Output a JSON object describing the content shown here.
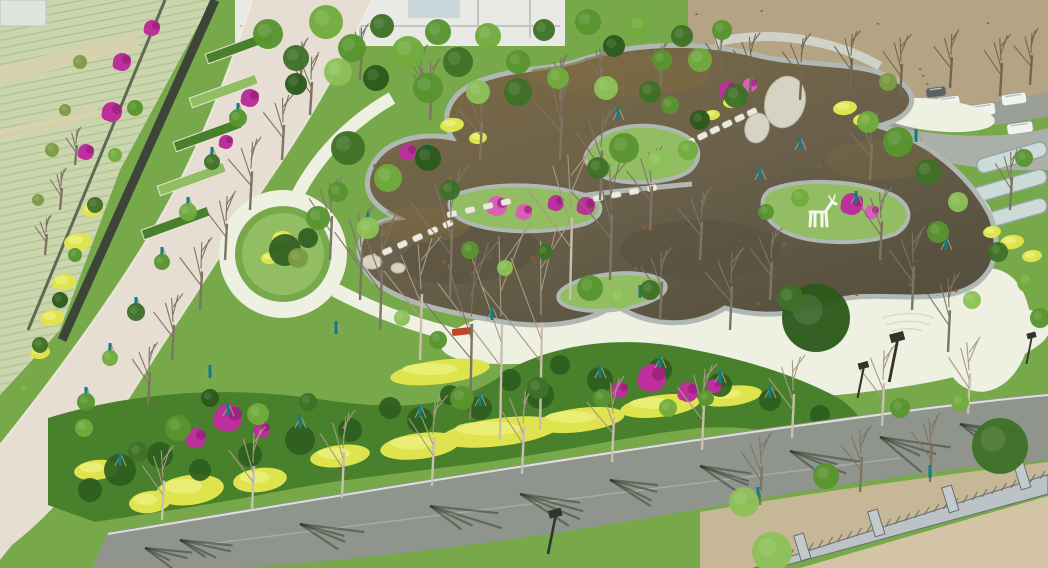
{
  "scene_type": "aerial-drone-photo-of-landscaped-pond-garden-park",
  "palette": {
    "plaza": "#eef0e2",
    "road_light": "#e6ded2",
    "asphalt": "#8f948c",
    "asphalt_light": "#a8aca2",
    "water_top": "#7d6b42",
    "water": "#6a604b",
    "water_dark": "#56503e",
    "speckle": "#8a5c33",
    "stone": "#b0b8b4",
    "stone_dark": "#87928d",
    "slab": "#eceadf",
    "lawn": "#77a94b",
    "lawn_light": "#92bd62",
    "lawn_dark": "#558a34",
    "shrub": "#49802c",
    "shrub_dark": "#2f5d20",
    "hedge_yellow": "#dfe44e",
    "hedge_yellow_light": "#ecf07e",
    "magenta": "#bd2f9b",
    "magenta_dark": "#971c77",
    "pink": "#d95fb8",
    "teal": "#0f7e86",
    "farmland": "#cbd6ae",
    "farmland_row": "#afc392",
    "farmland_tan": "#d8d2ae",
    "wall": "#3d4438",
    "fence_line": "#5f6a55",
    "field": "#b5a484",
    "field_dot": "#70684f",
    "dirt": "#d2c4a4",
    "dirt2": "#c6b896",
    "fence_gray": "#bcc3c6",
    "fence_dark": "#666d70",
    "building": "#e9eae5",
    "building_line": "#c3c6c0",
    "glass": "#c9d6da",
    "greenhouse": "#ccdad8",
    "greenhouse_line": "#8fa5a4",
    "trunk": "#c9c0ae",
    "branch": "#a89a82",
    "branch_dark": "#7e7464",
    "canopy1": "#3e7026",
    "canopy2": "#58942f",
    "canopy3": "#71ab3d",
    "canopy4": "#8cc157",
    "canopy5": "#2c5a1c",
    "canopy_olive": "#7d9a43",
    "shadow": "#2a3020",
    "lamp": "#32342c",
    "white": "#f6f6ef",
    "red": "#c0432b",
    "boulder": "#d6d3c4"
  },
  "scene": {
    "counts": {
      "pond_speckles": 75,
      "field_dots": 55
    },
    "canopies": [
      [
        268,
        34,
        15,
        2
      ],
      [
        296,
        58,
        13,
        1
      ],
      [
        326,
        22,
        17,
        3
      ],
      [
        352,
        48,
        14,
        2
      ],
      [
        382,
        26,
        12,
        1
      ],
      [
        408,
        52,
        16,
        3
      ],
      [
        438,
        32,
        13,
        2
      ],
      [
        296,
        84,
        11,
        5
      ],
      [
        338,
        72,
        14,
        4
      ],
      [
        458,
        62,
        15,
        1
      ],
      [
        488,
        36,
        13,
        3
      ],
      [
        518,
        62,
        12,
        2
      ],
      [
        544,
        30,
        11,
        1
      ],
      [
        376,
        78,
        13,
        5
      ],
      [
        428,
        88,
        15,
        2
      ],
      [
        478,
        92,
        12,
        4
      ],
      [
        518,
        92,
        14,
        1
      ],
      [
        558,
        78,
        11,
        3
      ],
      [
        588,
        22,
        13,
        2
      ],
      [
        614,
        46,
        11,
        5
      ],
      [
        640,
        26,
        12,
        3
      ],
      [
        662,
        60,
        10,
        2
      ],
      [
        682,
        36,
        11,
        1
      ],
      [
        606,
        88,
        12,
        4
      ],
      [
        650,
        92,
        11,
        1
      ],
      [
        700,
        60,
        12,
        3
      ],
      [
        722,
        30,
        10,
        2
      ],
      [
        624,
        148,
        15,
        2
      ],
      [
        658,
        162,
        12,
        4
      ],
      [
        598,
        168,
        11,
        1
      ],
      [
        688,
        150,
        10,
        3
      ],
      [
        590,
        288,
        13,
        2
      ],
      [
        620,
        298,
        11,
        4
      ],
      [
        650,
        290,
        10,
        1
      ],
      [
        800,
        198,
        9,
        3
      ],
      [
        766,
        212,
        8,
        2
      ],
      [
        736,
        96,
        12,
        1
      ],
      [
        700,
        120,
        10,
        5
      ],
      [
        670,
        105,
        9,
        2
      ],
      [
        348,
        148,
        17,
        1
      ],
      [
        388,
        178,
        14,
        3
      ],
      [
        318,
        218,
        12,
        2
      ],
      [
        298,
        258,
        10,
        6
      ],
      [
        428,
        158,
        13,
        5
      ],
      [
        368,
        228,
        11,
        4
      ],
      [
        338,
        192,
        10,
        2
      ],
      [
        450,
        190,
        10,
        1
      ],
      [
        816,
        318,
        34,
        5
      ],
      [
        790,
        298,
        13,
        1
      ],
      [
        898,
        142,
        15,
        2
      ],
      [
        928,
        172,
        13,
        1
      ],
      [
        868,
        122,
        11,
        3
      ],
      [
        958,
        202,
        10,
        4
      ],
      [
        938,
        232,
        11,
        2
      ],
      [
        998,
        252,
        10,
        1
      ],
      [
        888,
        82,
        9,
        6
      ],
      [
        1028,
        282,
        11,
        3
      ],
      [
        1024,
        158,
        9,
        2
      ],
      [
        972,
        300,
        9,
        4
      ],
      [
        1040,
        318,
        10,
        2
      ],
      [
        438,
        340,
        9,
        2
      ],
      [
        402,
        318,
        8,
        4
      ],
      [
        470,
        250,
        9,
        2
      ],
      [
        505,
        268,
        8,
        4
      ],
      [
        545,
        252,
        8,
        1
      ],
      [
        178,
        428,
        13,
        2
      ],
      [
        258,
        414,
        11,
        3
      ],
      [
        308,
        402,
        9,
        1
      ],
      [
        462,
        398,
        12,
        2
      ],
      [
        538,
        388,
        11,
        1
      ],
      [
        602,
        398,
        9,
        2
      ],
      [
        668,
        408,
        9,
        3
      ],
      [
        138,
        452,
        10,
        1
      ],
      [
        84,
        428,
        9,
        3
      ],
      [
        210,
        398,
        9,
        5
      ],
      [
        706,
        398,
        8,
        2
      ],
      [
        744,
        502,
        15,
        4
      ],
      [
        826,
        476,
        13,
        2
      ],
      [
        1000,
        446,
        28,
        1
      ],
      [
        772,
        552,
        20,
        4
      ],
      [
        900,
        408,
        10,
        2
      ],
      [
        960,
        402,
        9,
        3
      ],
      [
        238,
        118,
        9,
        2
      ],
      [
        212,
        162,
        8,
        1
      ],
      [
        188,
        212,
        9,
        3
      ],
      [
        162,
        262,
        8,
        2
      ],
      [
        136,
        312,
        9,
        1
      ],
      [
        110,
        358,
        8,
        3
      ],
      [
        86,
        402,
        9,
        2
      ],
      [
        60,
        300,
        8,
        5
      ],
      [
        75,
        255,
        7,
        2
      ],
      [
        95,
        205,
        8,
        1
      ],
      [
        115,
        155,
        7,
        3
      ],
      [
        135,
        108,
        8,
        2
      ],
      [
        40,
        345,
        8,
        1
      ],
      [
        25,
        390,
        7,
        3
      ],
      [
        52,
        150,
        7,
        6
      ],
      [
        65,
        110,
        6,
        6
      ],
      [
        80,
        62,
        7,
        6
      ],
      [
        38,
        200,
        6,
        6
      ]
    ],
    "bare_trees": [
      [
        162,
        520,
        72,
        1
      ],
      [
        252,
        510,
        80,
        1
      ],
      [
        342,
        498,
        84,
        1
      ],
      [
        432,
        486,
        88,
        1
      ],
      [
        522,
        474,
        86,
        1
      ],
      [
        612,
        462,
        82,
        1
      ],
      [
        702,
        450,
        84,
        1
      ],
      [
        792,
        438,
        80,
        1
      ],
      [
        882,
        426,
        78,
        1
      ],
      [
        968,
        414,
        74,
        1
      ],
      [
        250,
        210,
        70,
        2
      ],
      [
        225,
        260,
        66,
        2
      ],
      [
        200,
        310,
        70,
        2
      ],
      [
        172,
        360,
        64,
        2
      ],
      [
        148,
        405,
        60,
        2
      ],
      [
        282,
        160,
        64,
        2
      ],
      [
        310,
        115,
        60,
        2
      ],
      [
        60,
        210,
        40,
        2
      ],
      [
        45,
        255,
        38,
        2
      ],
      [
        75,
        165,
        36,
        2
      ],
      [
        500,
        440,
        210,
        1
      ],
      [
        540,
        430,
        195,
        1
      ],
      [
        470,
        420,
        175,
        2
      ],
      [
        570,
        300,
        150,
        1
      ],
      [
        610,
        280,
        120,
        2
      ],
      [
        450,
        300,
        130,
        2
      ],
      [
        380,
        330,
        110,
        2
      ],
      [
        420,
        360,
        120,
        1
      ],
      [
        750,
        95,
        60,
        3
      ],
      [
        800,
        100,
        64,
        3
      ],
      [
        850,
        90,
        58,
        3
      ],
      [
        900,
        98,
        62,
        3
      ],
      [
        950,
        88,
        56,
        3
      ],
      [
        1000,
        96,
        60,
        3
      ],
      [
        720,
        80,
        50,
        3
      ],
      [
        1030,
        85,
        54,
        3
      ],
      [
        912,
        310,
        80,
        2
      ],
      [
        948,
        352,
        76,
        2
      ],
      [
        880,
        260,
        70,
        2
      ],
      [
        1010,
        210,
        60,
        2
      ],
      [
        870,
        180,
        66,
        2
      ],
      [
        760,
        505,
        70,
        2
      ],
      [
        930,
        482,
        66,
        2
      ],
      [
        860,
        492,
        64,
        2
      ],
      [
        330,
        260,
        80,
        2
      ],
      [
        360,
        300,
        90,
        2
      ],
      [
        600,
        200,
        90,
        2
      ],
      [
        650,
        230,
        80,
        2
      ],
      [
        700,
        260,
        70,
        2
      ],
      [
        560,
        160,
        80,
        2
      ],
      [
        480,
        160,
        70,
        2
      ],
      [
        430,
        120,
        60,
        2
      ],
      [
        660,
        320,
        70,
        2
      ],
      [
        730,
        330,
        80,
        2
      ],
      [
        770,
        300,
        70,
        2
      ],
      [
        300,
        90,
        50,
        2
      ],
      [
        360,
        80,
        54,
        2
      ],
      [
        420,
        95,
        48,
        2
      ],
      [
        600,
        95,
        50,
        2
      ],
      [
        660,
        90,
        46,
        2
      ],
      [
        560,
        100,
        44,
        2
      ]
    ],
    "poles": [
      [
        420,
        418
      ],
      [
        480,
        406
      ],
      [
        540,
        393
      ],
      [
        600,
        378
      ],
      [
        660,
        368
      ],
      [
        720,
        383
      ],
      [
        770,
        398
      ],
      [
        228,
        416
      ],
      [
        180,
        430
      ],
      [
        120,
        466
      ],
      [
        86,
        400
      ],
      [
        856,
        204
      ],
      [
        800,
        150
      ],
      [
        760,
        180
      ],
      [
        916,
        142
      ],
      [
        946,
        250
      ],
      [
        618,
        120
      ],
      [
        640,
        298
      ],
      [
        492,
        320
      ],
      [
        758,
        500
      ],
      [
        930,
        478
      ],
      [
        188,
        210
      ],
      [
        162,
        260
      ],
      [
        136,
        310
      ],
      [
        110,
        356
      ],
      [
        238,
        116
      ],
      [
        212,
        160
      ],
      [
        350,
        146
      ],
      [
        390,
        176
      ],
      [
        428,
        156
      ],
      [
        368,
        226
      ],
      [
        210,
        378
      ],
      [
        300,
        428
      ],
      [
        336,
        334
      ]
    ],
    "magenta": [
      [
        152,
        28,
        8,
        1
      ],
      [
        122,
        62,
        9,
        1
      ],
      [
        112,
        112,
        10,
        1
      ],
      [
        86,
        152,
        8,
        1
      ],
      [
        250,
        98,
        9,
        1
      ],
      [
        226,
        142,
        7,
        1
      ],
      [
        228,
        418,
        14,
        1
      ],
      [
        196,
        438,
        10,
        1
      ],
      [
        262,
        430,
        8,
        1
      ],
      [
        652,
        378,
        14,
        1
      ],
      [
        688,
        392,
        10,
        1
      ],
      [
        620,
        390,
        8,
        1
      ],
      [
        714,
        386,
        7,
        1
      ],
      [
        497,
        206,
        10,
        2
      ],
      [
        524,
        212,
        8,
        2
      ],
      [
        556,
        203,
        8,
        1
      ],
      [
        586,
        206,
        9,
        1
      ],
      [
        728,
        90,
        9,
        1
      ],
      [
        750,
        85,
        7,
        2
      ],
      [
        852,
        204,
        11,
        1
      ],
      [
        872,
        212,
        7,
        2
      ],
      [
        408,
        152,
        8,
        1
      ]
    ],
    "yellow": [
      [
        78,
        242,
        14,
        9
      ],
      [
        64,
        282,
        12,
        8
      ],
      [
        52,
        318,
        12,
        8
      ],
      [
        92,
        210,
        10,
        7
      ],
      [
        40,
        352,
        10,
        7
      ],
      [
        452,
        125,
        12,
        7
      ],
      [
        478,
        138,
        9,
        6
      ],
      [
        733,
        102,
        10,
        6
      ],
      [
        712,
        115,
        8,
        5
      ],
      [
        845,
        108,
        12,
        7
      ],
      [
        862,
        120,
        9,
        6
      ],
      [
        1012,
        242,
        12,
        7
      ],
      [
        1032,
        256,
        10,
        6
      ],
      [
        992,
        232,
        9,
        6
      ],
      [
        282,
        238,
        10,
        7
      ],
      [
        270,
        258,
        9,
        6
      ],
      [
        190,
        490,
        34,
        15
      ],
      [
        260,
        480,
        27,
        12
      ],
      [
        150,
        502,
        21,
        11
      ],
      [
        500,
        432,
        60,
        14
      ],
      [
        420,
        446,
        40,
        13
      ],
      [
        580,
        420,
        45,
        12
      ],
      [
        660,
        406,
        40,
        11
      ],
      [
        730,
        396,
        32,
        10
      ],
      [
        440,
        372,
        50,
        12
      ],
      [
        795,
        440,
        28,
        9
      ],
      [
        340,
        456,
        30,
        11
      ],
      [
        96,
        470,
        22,
        10
      ]
    ],
    "shrubs_dark": [
      [
        120,
        470,
        16
      ],
      [
        160,
        455,
        13
      ],
      [
        300,
        440,
        15
      ],
      [
        350,
        430,
        12
      ],
      [
        420,
        420,
        13
      ],
      [
        480,
        408,
        12
      ],
      [
        540,
        395,
        14
      ],
      [
        600,
        380,
        13
      ],
      [
        660,
        370,
        12
      ],
      [
        720,
        385,
        12
      ],
      [
        770,
        400,
        11
      ],
      [
        90,
        490,
        12
      ],
      [
        250,
        455,
        12
      ],
      [
        200,
        470,
        11
      ],
      [
        560,
        365,
        10
      ],
      [
        510,
        380,
        11
      ],
      [
        450,
        395,
        10
      ],
      [
        390,
        408,
        11
      ],
      [
        820,
        415,
        10
      ],
      [
        285,
        250,
        16
      ],
      [
        308,
        238,
        10
      ]
    ],
    "shadows": [
      [
        180,
        540,
        70
      ],
      [
        300,
        524,
        80
      ],
      [
        430,
        506,
        90
      ],
      [
        520,
        494,
        85
      ],
      [
        610,
        480,
        80
      ],
      [
        700,
        466,
        85
      ],
      [
        790,
        451,
        75
      ],
      [
        880,
        437,
        85
      ],
      [
        960,
        424,
        70
      ],
      [
        145,
        548,
        55
      ]
    ],
    "stone_chains": [
      [
        690,
        142,
        752,
        112,
        6
      ],
      [
        598,
        198,
        652,
        188,
        4
      ],
      [
        372,
        258,
        448,
        224,
        6
      ],
      [
        452,
        214,
        506,
        202,
        4
      ]
    ],
    "cars": [
      [
        948,
        102,
        24,
        11,
        -8,
        0
      ],
      [
        982,
        110,
        27,
        12,
        -8,
        0
      ],
      [
        1014,
        99,
        25,
        11,
        -8,
        0
      ],
      [
        1020,
        128,
        26,
        11,
        -8,
        0
      ],
      [
        936,
        92,
        20,
        10,
        -8,
        1
      ]
    ],
    "lamps": [
      [
        898,
        338,
        1.1
      ],
      [
        864,
        366,
        0.8
      ],
      [
        556,
        514,
        1.0
      ],
      [
        1032,
        336,
        0.7
      ]
    ]
  }
}
